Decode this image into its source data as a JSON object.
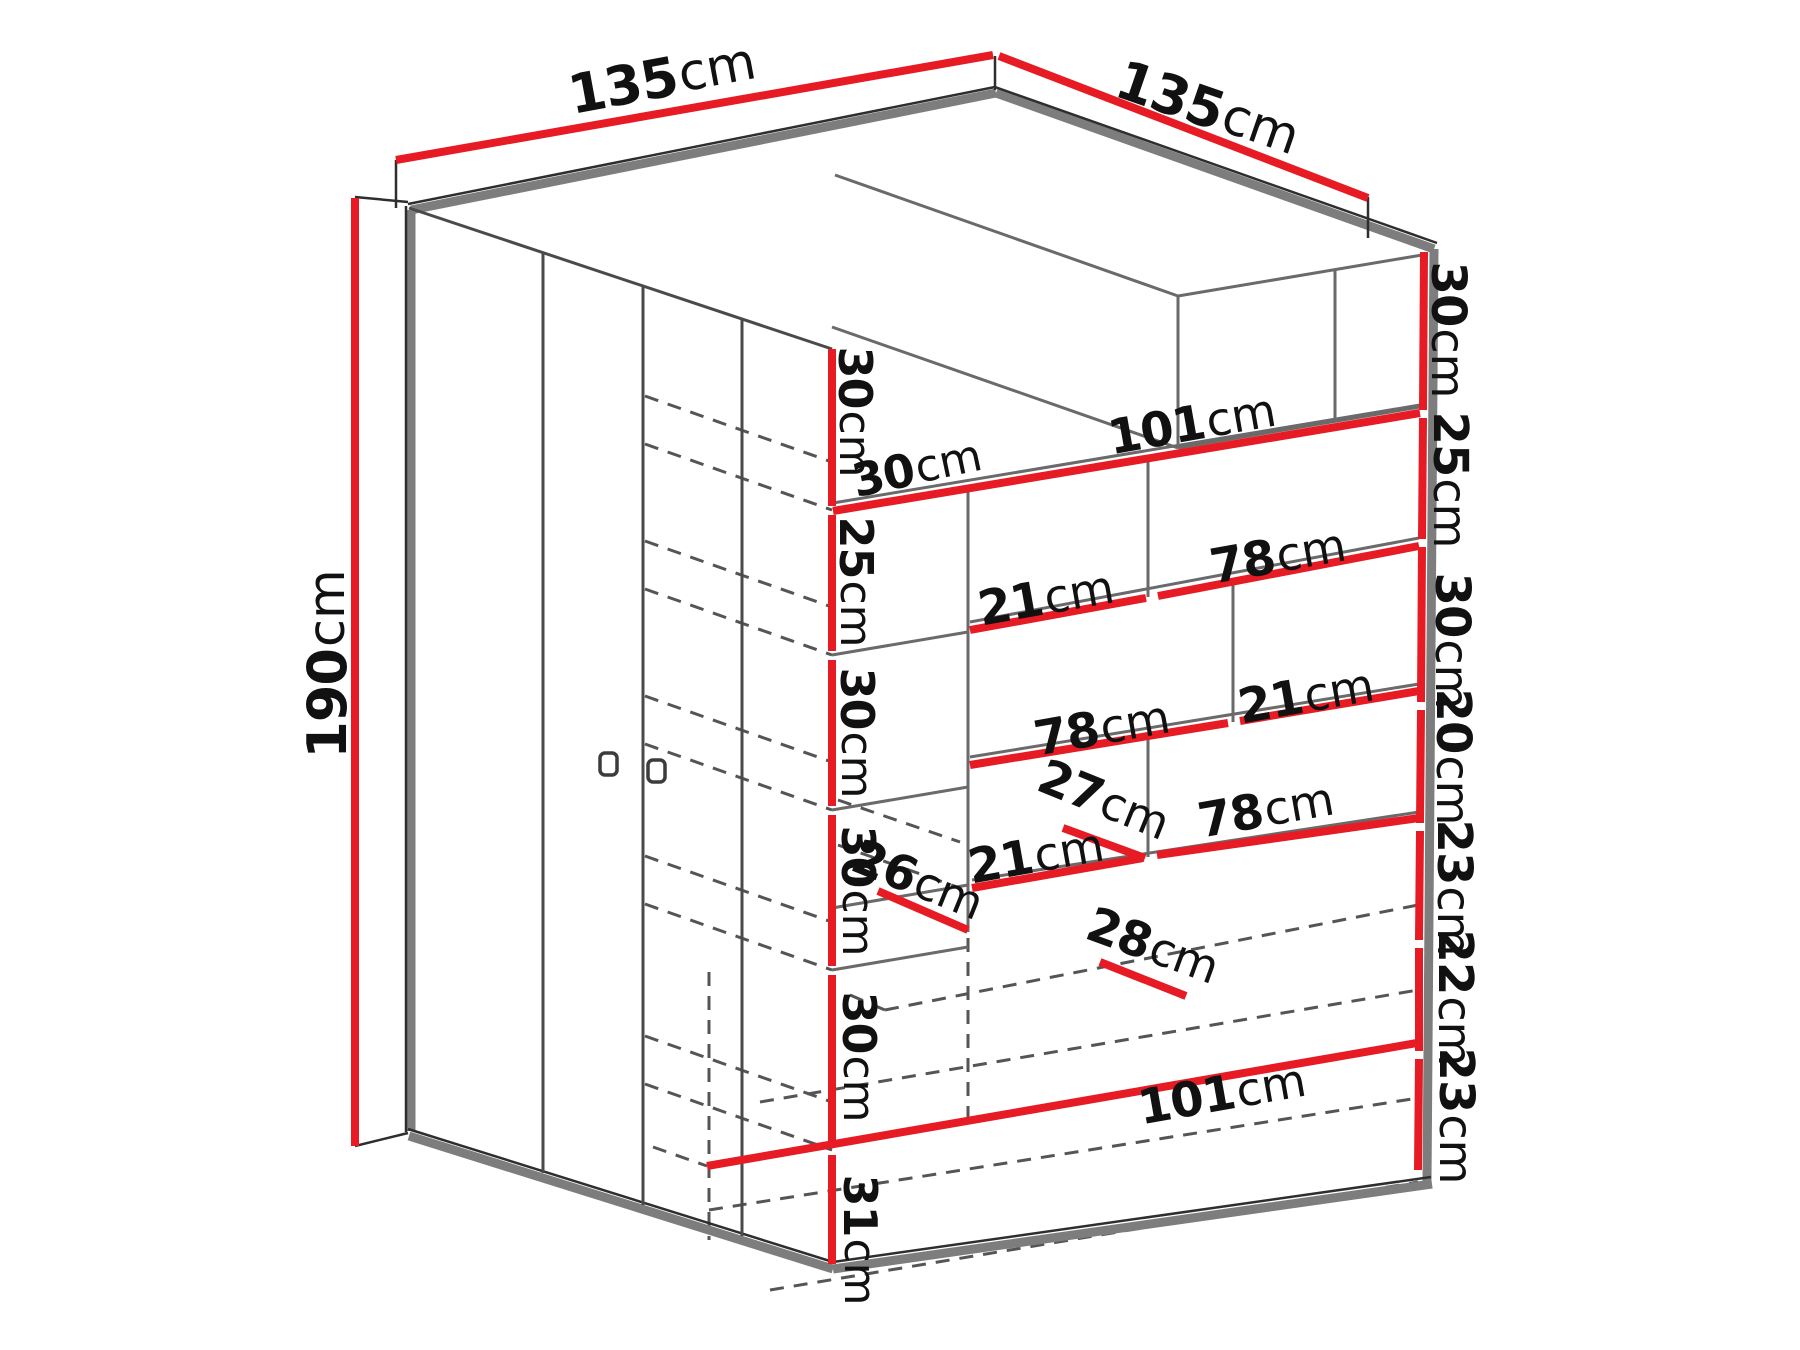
{
  "diagram": {
    "type": "furniture-dimension-diagram",
    "subject": "corner-wardrobe-with-shelves",
    "colors": {
      "background": "#ffffff",
      "dimension_red": "#e61b23",
      "edge_gray": "#7d7d7d",
      "line_dark": "#2e2e2e",
      "hidden_gray": "#555555"
    },
    "overall": {
      "width_left": "135cm",
      "width_right": "135cm",
      "height": "190cm"
    },
    "labels": [
      {
        "id": "top-left-width",
        "num": "135",
        "unit": "cm",
        "x": 662,
        "y": 78,
        "r": -10.5,
        "s": 54
      },
      {
        "id": "top-right-width",
        "num": "135",
        "unit": "cm",
        "x": 1208,
        "y": 108,
        "r": 19,
        "s": 54
      },
      {
        "id": "height-190",
        "num": "190",
        "unit": "cm",
        "x": 327,
        "y": 664,
        "r": -90,
        "s": 54
      },
      {
        "id": "right-seg-30a",
        "num": "30",
        "unit": "cm",
        "x": 1448,
        "y": 330,
        "r": 90,
        "s": 48
      },
      {
        "id": "right-seg-25",
        "num": "25",
        "unit": "cm",
        "x": 1450,
        "y": 480,
        "r": 90,
        "s": 48
      },
      {
        "id": "right-seg-30b",
        "num": "30",
        "unit": "cm",
        "x": 1452,
        "y": 641,
        "r": 90,
        "s": 48
      },
      {
        "id": "right-seg-20",
        "num": "20",
        "unit": "cm",
        "x": 1453,
        "y": 757,
        "r": 90,
        "s": 48
      },
      {
        "id": "right-seg-23a",
        "num": "23",
        "unit": "cm",
        "x": 1454,
        "y": 888,
        "r": 90,
        "s": 48
      },
      {
        "id": "right-seg-22",
        "num": "22",
        "unit": "cm",
        "x": 1455,
        "y": 998,
        "r": 90,
        "s": 48
      },
      {
        "id": "right-seg-23b",
        "num": "23",
        "unit": "cm",
        "x": 1456,
        "y": 1116,
        "r": 90,
        "s": 48
      },
      {
        "id": "inner-seg-30a",
        "num": "30",
        "unit": "cm",
        "x": 855,
        "y": 412,
        "r": 90,
        "s": 46
      },
      {
        "id": "inner-seg-25",
        "num": "25",
        "unit": "cm",
        "x": 856,
        "y": 582,
        "r": 90,
        "s": 46
      },
      {
        "id": "inner-seg-30b",
        "num": "30",
        "unit": "cm",
        "x": 857,
        "y": 733,
        "r": 90,
        "s": 46
      },
      {
        "id": "inner-seg-30c",
        "num": "30",
        "unit": "cm",
        "x": 858,
        "y": 891,
        "r": 90,
        "s": 46
      },
      {
        "id": "inner-seg-30d",
        "num": "30",
        "unit": "cm",
        "x": 859,
        "y": 1057,
        "r": 90,
        "s": 46
      },
      {
        "id": "inner-seg-31",
        "num": "31",
        "unit": "cm",
        "x": 860,
        "y": 1240,
        "r": 90,
        "s": 46
      },
      {
        "id": "shelf-top-30",
        "num": "30",
        "unit": "cm",
        "x": 917,
        "y": 468,
        "r": -12,
        "s": 46
      },
      {
        "id": "shelf-top-101",
        "num": "101",
        "unit": "cm",
        "x": 1192,
        "y": 424,
        "r": -10,
        "s": 48
      },
      {
        "id": "shelf2-21",
        "num": "21",
        "unit": "cm",
        "x": 1046,
        "y": 598,
        "r": -10,
        "s": 48
      },
      {
        "id": "shelf2-78",
        "num": "78",
        "unit": "cm",
        "x": 1278,
        "y": 556,
        "r": -10,
        "s": 48
      },
      {
        "id": "shelf3-78",
        "num": "78",
        "unit": "cm",
        "x": 1102,
        "y": 728,
        "r": -10,
        "s": 48
      },
      {
        "id": "shelf3-21",
        "num": "21",
        "unit": "cm",
        "x": 1306,
        "y": 696,
        "r": -10,
        "s": 48
      },
      {
        "id": "shelf4-21",
        "num": "21",
        "unit": "cm",
        "x": 1036,
        "y": 856,
        "r": -10,
        "s": 48
      },
      {
        "id": "shelf4-27",
        "num": "27",
        "unit": "cm",
        "x": 1104,
        "y": 800,
        "r": 22,
        "s": 48
      },
      {
        "id": "shelf4-78",
        "num": "78",
        "unit": "cm",
        "x": 1266,
        "y": 810,
        "r": -10,
        "s": 48
      },
      {
        "id": "corner-26",
        "num": "26",
        "unit": "cm",
        "x": 918,
        "y": 880,
        "r": 22,
        "s": 48
      },
      {
        "id": "drawer-28",
        "num": "28",
        "unit": "cm",
        "x": 1153,
        "y": 946,
        "r": 20,
        "s": 48
      },
      {
        "id": "bottom-101",
        "num": "101",
        "unit": "cm",
        "x": 1222,
        "y": 1094,
        "r": -10,
        "s": 48
      }
    ]
  }
}
